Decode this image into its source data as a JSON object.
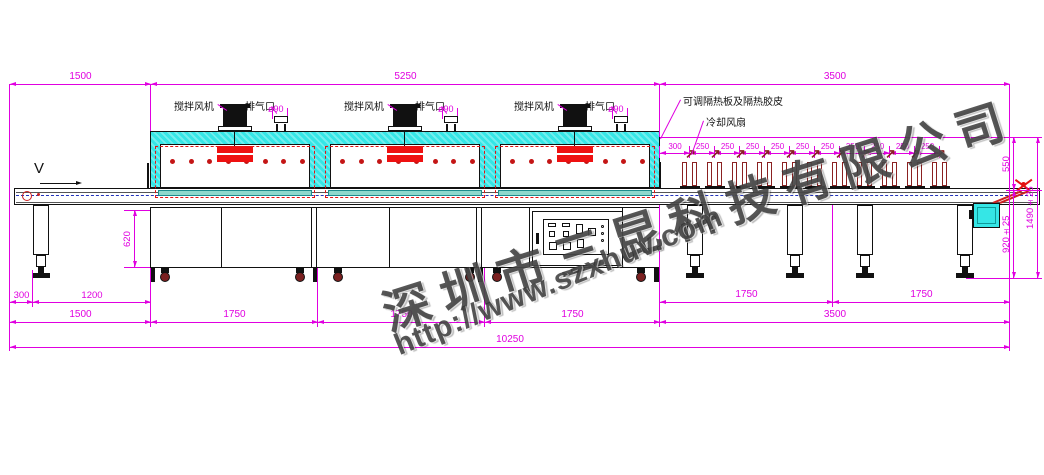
{
  "drawing": {
    "machine_labels": {
      "stir_fan": "搅拌风机",
      "exhaust_port": "排气口",
      "exhaust_diameter": "ø90",
      "insulation_note": "可调隔热板及隔热胶皮",
      "cooling_fan_note": "冷却风扇",
      "belt_direction": "V"
    },
    "watermark": {
      "company": "深圳市三昆科技有限公司",
      "website": "http://www.szxhuv.com"
    },
    "dimensions_mm": {
      "top_sections": [
        "1500",
        "5250",
        "3500"
      ],
      "cooling_fan_pitch": [
        "300",
        "250",
        "250",
        "250",
        "250",
        "250",
        "250",
        "250",
        "250",
        "250",
        "250"
      ],
      "right_heights": [
        "550",
        "920±25",
        "1490±25"
      ],
      "leg_height": "620",
      "bottom_left": [
        "300",
        "1200"
      ],
      "bottom_sections": [
        "1500",
        "1750",
        "1750",
        "1750"
      ],
      "bottom_cooling": [
        "1750",
        "1750"
      ],
      "cooling_total": "3500",
      "overall_length": "10250"
    },
    "colors": {
      "dimension": "#e000e0",
      "tunnel_shell": "#35e6e6",
      "heater": "#ee1111",
      "belt_mesh": "#8fd8cc",
      "centerline": "#2233bb",
      "fan_dark_red": "#8b2121"
    }
  }
}
